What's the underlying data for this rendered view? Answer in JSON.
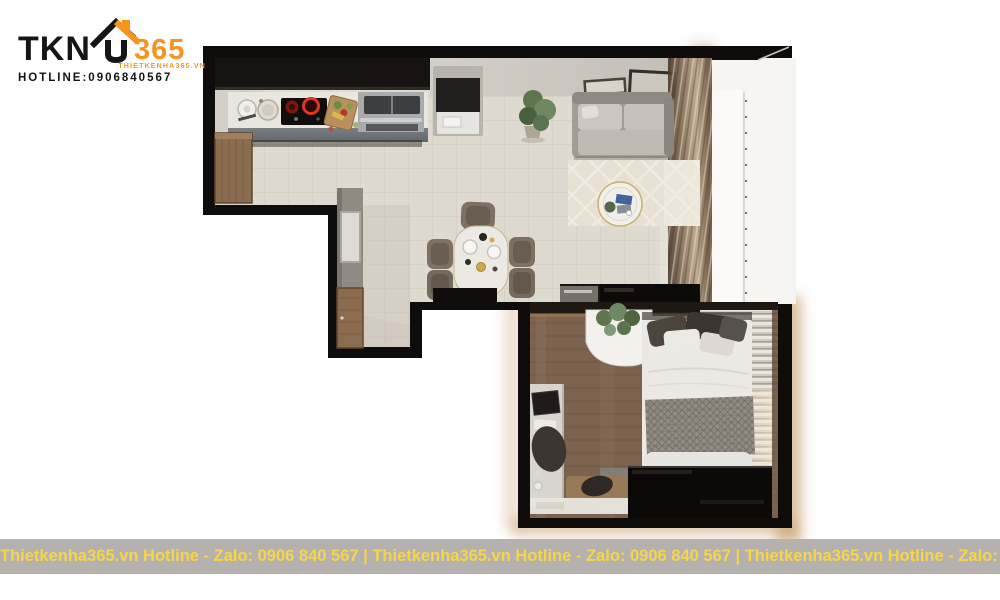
{
  "brand": {
    "name_prefix": "TKN",
    "name_suffix": "365",
    "website_small": "THIETKENHA365.VN",
    "hotline_label": "HOTLINE:0906840567",
    "accent_orange": "#F7941D",
    "text_black": "#151515"
  },
  "footer": {
    "segment": "Thietkenha365.vn Hotline - Zalo: 0906 840 567",
    "line": "Thietkenha365.vn Hotline - Zalo: 0906 840 567 | Thietkenha365.vn Hotline - Zalo: 0906 840 567 | Thietkenha365.vn Hotline - Zalo: 0906 840 567",
    "bar_color": "#B5B1AE",
    "text_color": "#F7D54A"
  },
  "floorplan": {
    "rooms": [
      "kitchen",
      "dining-area",
      "living-room",
      "entry-hall",
      "balcony",
      "bedroom"
    ],
    "furniture": [
      "kitchen-counter",
      "induction-hob",
      "sink",
      "water-heater",
      "cutting-board",
      "fridge",
      "plant",
      "sofa",
      "wall-frames",
      "area-rug",
      "coffee-table",
      "dining-table",
      "dining-chairs",
      "tv-console",
      "entry-door",
      "hall-partition",
      "bed",
      "pillows",
      "knit-blanket",
      "wardrobe",
      "desk",
      "desk-chair",
      "bedroom-rug",
      "window-blinds",
      "curtains"
    ],
    "palette": {
      "wall_black": "#0E0D0B",
      "floor_tile": "#D7D1C5",
      "wood_floor": "#7C6350",
      "counter_front": "#6F767B",
      "sofa_gray": "#A19C95",
      "rug_cream": "#E7E1D4",
      "warm_glow": "#C79A66",
      "balcony_white": "#F6F5F2"
    }
  }
}
